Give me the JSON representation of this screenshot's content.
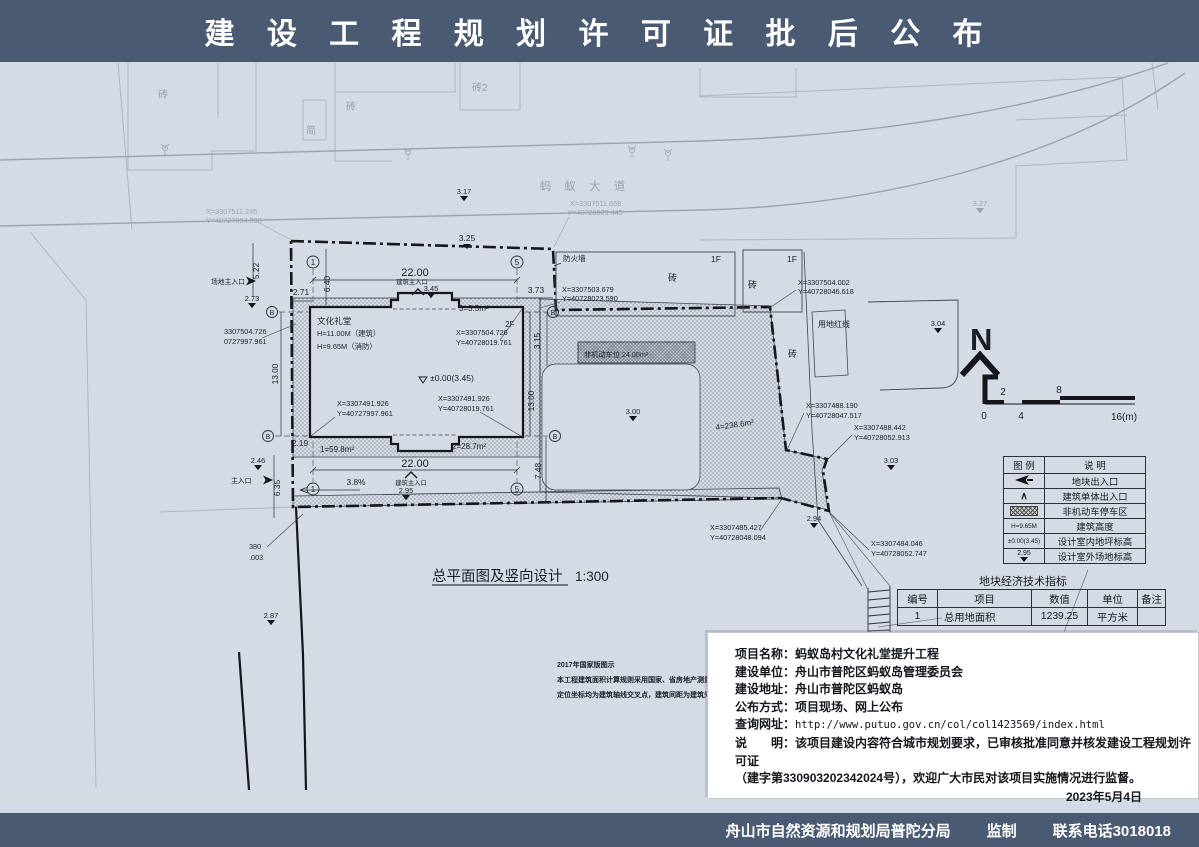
{
  "header": {
    "title": "建 设 工 程 规 划 许 可 证 批 后 公 布"
  },
  "footer": {
    "agency": "舟山市自然资源和规划局普陀分局",
    "label": "监制",
    "phone": "联系电话3018018"
  },
  "dw": {
    "road": "蚂 蚁 大 道",
    "title": "总平面图及竖向设计",
    "scale": "1:300",
    "firewall": "防火墙",
    "redline": "用地红线",
    "bricks": {
      "a": "砖",
      "jian": "简",
      "b2": "砖2"
    },
    "f1": "1F",
    "bldg": {
      "name": "文化礼堂",
      "h1": "H=11.00M（建筑）",
      "h2": "H=9.65M（消防）",
      "floor": "2F",
      "level": "±0.00(3.45)"
    },
    "areas": {
      "a1": "1=59.8m²",
      "a2": "2=28.7m²",
      "a3": "3=3.5m²",
      "a4": "4=238.6m²",
      "bike": "非机动车位 24.00m²"
    },
    "dims": {
      "d325": "3.25",
      "d2200": "22.00",
      "d640": "6.40",
      "d271": "2.71",
      "d522": "5.22",
      "d373": "3.73",
      "d315": "3.15",
      "d1300": "13.00",
      "d748": "7.48",
      "d219": "2.19",
      "d635": "6.35",
      "slope": "3.8%"
    },
    "lv": {
      "e317": "3.17",
      "e327": "3.27",
      "e273": "2.73",
      "e345": "3.45",
      "e300": "3.00",
      "e304": "3.04",
      "e303": "3.03",
      "e294": "2.94",
      "e295": "2.95",
      "e246": "2.46",
      "e287": "2.87"
    },
    "ent": {
      "site": "场地主入口",
      "main": "主入口",
      "bldg": "建筑主入口"
    },
    "co": {
      "c1a": "X=3307511.245",
      "c1b": "Y=40727994.898",
      "c2a": "X=3307511.668",
      "c2b": "Y=40728023.445",
      "c3a": "X=3307503.679",
      "c3b": "Y=40728023.590",
      "c4a": "X=3307504.002",
      "c4b": "Y=40728046.618",
      "c5a": "X=3307504.726",
      "c5b": "Y=40728019.761",
      "c6a": "3307504.726",
      "c6b": "0727997.961",
      "c7a": "X=3307491.926",
      "c7b": "Y=40727997.961",
      "c8a": "X=3307491.926",
      "c8b": "Y=40728019.761",
      "c9a": "X=3307488.190",
      "c9b": "Y=40728047.517",
      "c10a": "X=3307488.442",
      "c10b": "Y=40728052.913",
      "c11a": "X=3307485.427",
      "c11b": "Y=40728048.094",
      "c12a": "X=3307484.046",
      "c12b": "Y=40728052.747",
      "c13a": "380",
      "c13b": ".003"
    },
    "grid": {
      "g1": "1",
      "g5": "5",
      "gb": "B"
    },
    "north": "N",
    "sb": {
      "t2": "2",
      "t8": "8",
      "b0": "0",
      "b4": "4",
      "b16": "16(m)"
    },
    "notes": [
      "2017年国家版图示",
      "本工程建筑面积计算规则采用国家、省房地产测量规范",
      "定位坐标均为建筑轴线交叉点，建筑间距为建筑外墙间距"
    ]
  },
  "legend": {
    "h1": "图  例",
    "h2": "说  明",
    "icon4": "H=9.65M",
    "icon5": "±0.00(3.45)",
    "icon6": "2.95",
    "r1": "地块出入口",
    "r2": "建筑单体出入口",
    "r3": "非机动车停车区",
    "r4": "建筑高度",
    "r5": "设计室内地坪标高",
    "r6": "设计室外场地标高"
  },
  "econ": {
    "title": "地块经济技术指标",
    "h": [
      "编号",
      "项目",
      "数值",
      "单位",
      "备注"
    ],
    "r": [
      "1",
      "总用地面积",
      "1239.25",
      "平方米",
      ""
    ]
  },
  "notice": {
    "f1l": "项目名称：",
    "f1v": "蚂蚁岛村文化礼堂提升工程",
    "f2l": "建设单位：",
    "f2v": "舟山市普陀区蚂蚁岛管理委员会",
    "f3l": "建设地址：",
    "f3v": "舟山市普陀区蚂蚁岛",
    "f4l": "公布方式：",
    "f4v": "项目现场、网上公布",
    "f5l": "查询网址：",
    "f5v": "http://www.putuo.gov.cn/col/col1423569/index.html",
    "f6l": "说　　明：",
    "f6v": "该项目建设内容符合城市规划要求，已审核批准同意并核发建设工程规划许可证",
    "f7v": "（建字第330903202342024号），欢迎广大市民对该项目实施情况进行监督。",
    "date": "2023年5月4日"
  },
  "colors": {
    "banner": "#4b5a73",
    "canvas": "#d5dbe5",
    "ink": "#1b1e26",
    "faint": "#aeb5c3"
  }
}
